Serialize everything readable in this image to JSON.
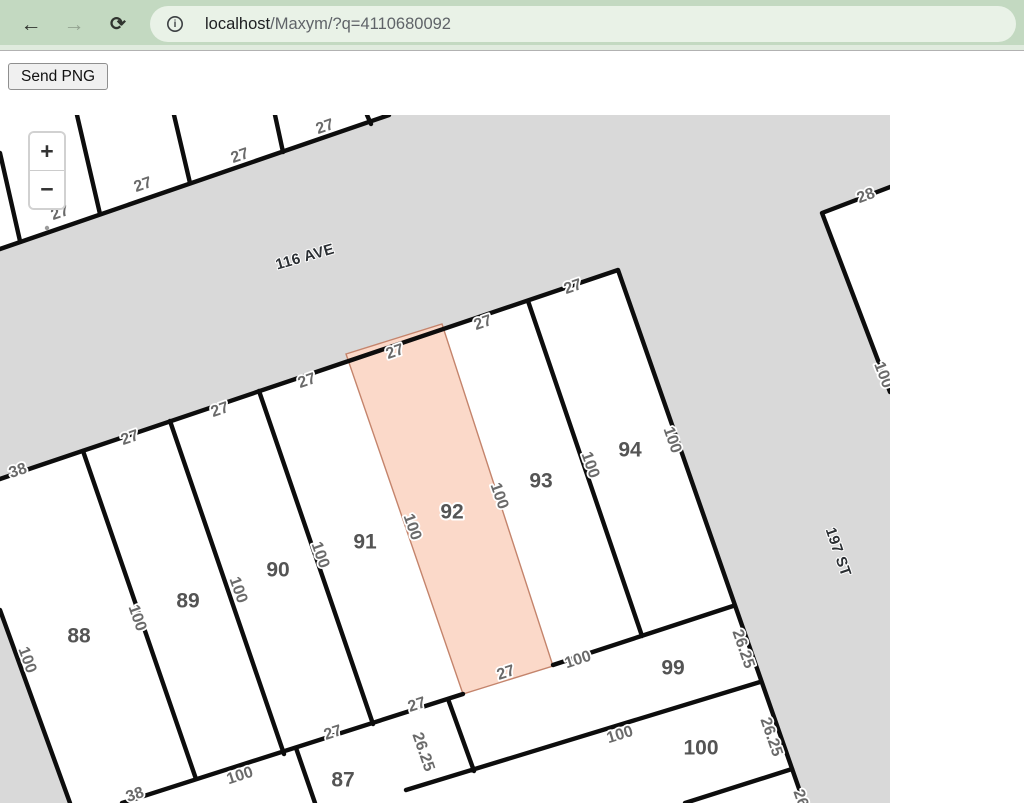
{
  "browser": {
    "back_icon": "←",
    "forward_icon": "→",
    "reload_icon": "⟳",
    "info_icon": "i",
    "url_primary": "localhost",
    "url_secondary": "/Maxym/?q=4110680092"
  },
  "page": {
    "send_button": "Send PNG"
  },
  "map": {
    "zoom_in": "+",
    "zoom_out": "−",
    "colors": {
      "street_fill": "#d9d9d9",
      "line": "#0d0d0d",
      "highlight_fill": "#fbd9c9",
      "highlight_stroke": "#c4846c",
      "dim_text": "#6a6a6a",
      "lot_text": "#545454",
      "street_text": "#2b2f33"
    },
    "streets": [
      {
        "text": "116 AVE",
        "x": 305,
        "y": 142,
        "rot": -16
      },
      {
        "text": "197 ST",
        "x": 838,
        "y": 437,
        "rot": 71
      }
    ],
    "lots": [
      {
        "text": "87",
        "x": 343,
        "y": 665
      },
      {
        "text": "88",
        "x": 79,
        "y": 521
      },
      {
        "text": "89",
        "x": 188,
        "y": 486
      },
      {
        "text": "90",
        "x": 278,
        "y": 455
      },
      {
        "text": "91",
        "x": 365,
        "y": 427
      },
      {
        "text": "92",
        "x": 452,
        "y": 397
      },
      {
        "text": "93",
        "x": 541,
        "y": 366
      },
      {
        "text": "94",
        "x": 630,
        "y": 335
      },
      {
        "text": "99",
        "x": 673,
        "y": 553
      },
      {
        "text": "100",
        "x": 701,
        "y": 633
      }
    ],
    "dimensions": [
      {
        "text": "27",
        "x": 60,
        "y": 98,
        "rot": -19
      },
      {
        "text": "27",
        "x": 143,
        "y": 70,
        "rot": -19
      },
      {
        "text": "27",
        "x": 240,
        "y": 41,
        "rot": -19
      },
      {
        "text": "27",
        "x": 325,
        "y": 12,
        "rot": -19
      },
      {
        "text": "28",
        "x": 866,
        "y": 81,
        "rot": -21
      },
      {
        "text": "100",
        "x": 883,
        "y": 260,
        "rot": 69
      },
      {
        "text": "38",
        "x": 18,
        "y": 356,
        "rot": -19
      },
      {
        "text": "27",
        "x": 130,
        "y": 323,
        "rot": -19
      },
      {
        "text": "27",
        "x": 220,
        "y": 295,
        "rot": -19
      },
      {
        "text": "27",
        "x": 307,
        "y": 266,
        "rot": -19
      },
      {
        "text": "27",
        "x": 395,
        "y": 237,
        "rot": -19
      },
      {
        "text": "27",
        "x": 483,
        "y": 208,
        "rot": -19
      },
      {
        "text": "27",
        "x": 573,
        "y": 172,
        "rot": -19
      },
      {
        "text": "100",
        "x": 137,
        "y": 503,
        "rot": 71
      },
      {
        "text": "100",
        "x": 238,
        "y": 475,
        "rot": 71
      },
      {
        "text": "100",
        "x": 320,
        "y": 440,
        "rot": 71
      },
      {
        "text": "100",
        "x": 412,
        "y": 412,
        "rot": 71
      },
      {
        "text": "100",
        "x": 499,
        "y": 381,
        "rot": 71
      },
      {
        "text": "100",
        "x": 590,
        "y": 350,
        "rot": 71
      },
      {
        "text": "100",
        "x": 672,
        "y": 325,
        "rot": 71
      },
      {
        "text": "100",
        "x": 27,
        "y": 545,
        "rot": 70
      },
      {
        "text": "38",
        "x": 135,
        "y": 680,
        "rot": -19
      },
      {
        "text": "100",
        "x": 240,
        "y": 661,
        "rot": -18
      },
      {
        "text": "27",
        "x": 333,
        "y": 618,
        "rot": -18
      },
      {
        "text": "27",
        "x": 417,
        "y": 590,
        "rot": -18
      },
      {
        "text": "27",
        "x": 506,
        "y": 558,
        "rot": -18
      },
      {
        "text": "100",
        "x": 578,
        "y": 545,
        "rot": -18
      },
      {
        "text": "100",
        "x": 620,
        "y": 620,
        "rot": -17
      },
      {
        "text": "26.25",
        "x": 743,
        "y": 534,
        "rot": 71
      },
      {
        "text": "26.25",
        "x": 771,
        "y": 622,
        "rot": 71
      },
      {
        "text": "26.25",
        "x": 423,
        "y": 637,
        "rot": 71
      },
      {
        "text": "26.25",
        "x": 804,
        "y": 694,
        "rot": 71
      }
    ]
  }
}
